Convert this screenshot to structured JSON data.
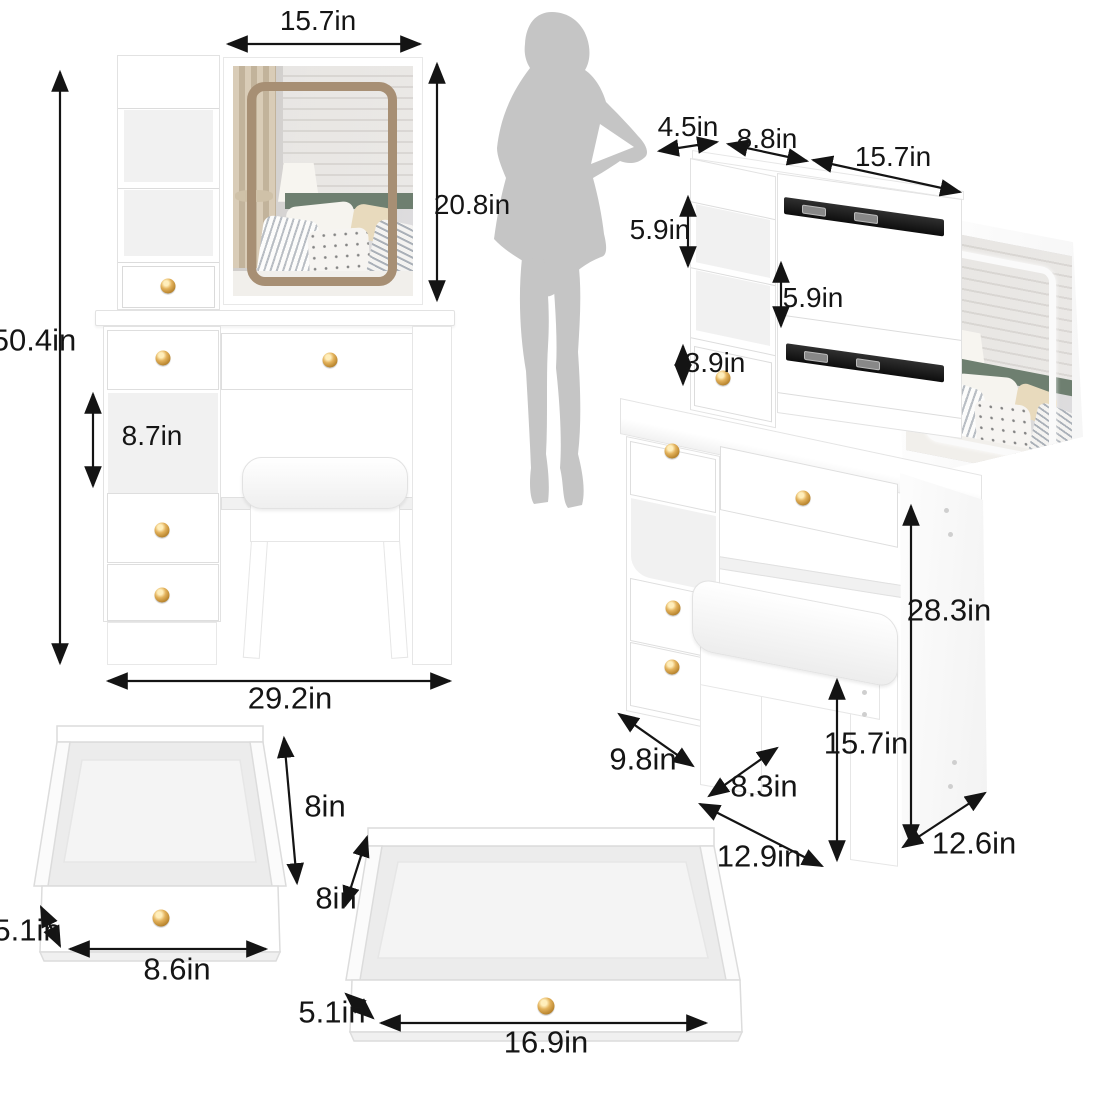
{
  "page": {
    "background": "#ffffff",
    "unit": "in"
  },
  "colors": {
    "label_text": "#151515",
    "knob_gold": "#c89b3c",
    "rail_black": "#161616",
    "silhouette_gray": "#c5c5c5",
    "mirror_frame_tan": "#a78f74",
    "led_ring_white": "#fafafa",
    "headboard_green": "#6e7f70"
  },
  "figures": {
    "front_view": {
      "description": "vanity desk with mirror and stool, front view",
      "labels": {
        "mirror_width": "15.7in",
        "mirror_height": "20.8in",
        "total_height": "50.4in",
        "shelf_opening_height": "8.7in",
        "total_width": "29.2in"
      }
    },
    "side_view": {
      "description": "vanity desk angled view with sliding mirror on rails",
      "labels": {
        "top_shelf_depth": "4.5in",
        "hutch_depth": "8.8in",
        "mirror_slide_width": "15.7in",
        "upper_shelf_height": "5.9in",
        "lower_shelf_height": "5.9in",
        "hutch_drawer_height": "3.9in",
        "tabletop_height": "28.3in",
        "stool_height": "15.7in",
        "desk_side_depth": "9.8in",
        "stool_seat_depth": "8.3in",
        "stool_width": "12.9in",
        "side_panel_depth": "12.6in"
      }
    },
    "small_drawer": {
      "description": "open small drawer, top view",
      "labels": {
        "depth": "8in",
        "height": "5.1in",
        "width": "8.6in"
      }
    },
    "large_drawer": {
      "description": "open wide drawer, top view",
      "labels": {
        "depth": "8in",
        "height": "5.1in",
        "width": "16.9in"
      }
    }
  }
}
